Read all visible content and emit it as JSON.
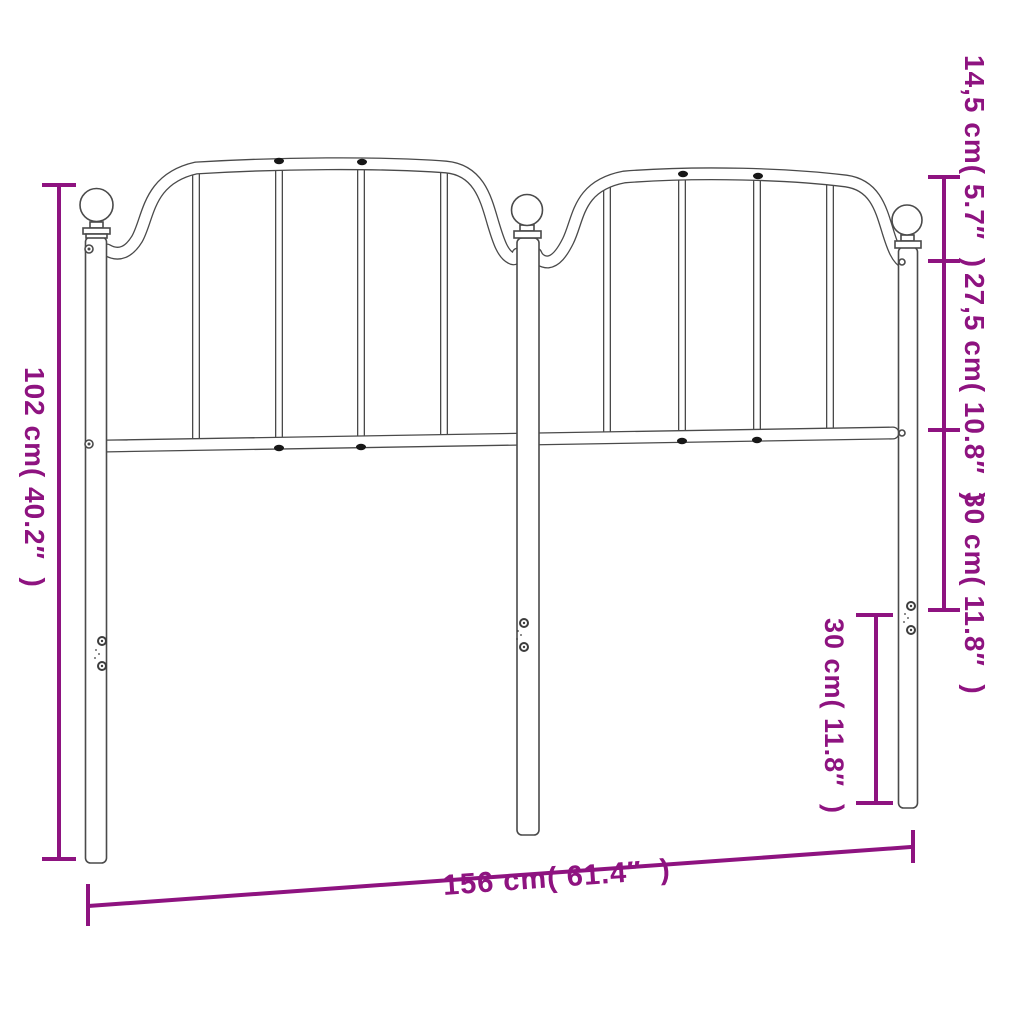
{
  "style": {
    "accent_color": "#8e1380",
    "drawing_line_color": "#4a4a4a",
    "background": "#ffffff"
  },
  "dimensions": {
    "height": {
      "label": "102 cm( 40.2″  )",
      "cm": "102",
      "inch": "40.2"
    },
    "width": {
      "label": "156 cm( 61.4″  )",
      "cm": "156",
      "inch": "61.4"
    },
    "top_rail_drop": {
      "label": "14,5 cm( 5.7″  )",
      "cm": "14,5",
      "inch": "5.7"
    },
    "panel_height": {
      "label": "27,5 cm( 10.8″  )",
      "cm": "27,5",
      "inch": "10.8"
    },
    "rail_to_leg": {
      "label": "30 cm( 11.8″  )",
      "cm": "30",
      "inch": "11.8"
    },
    "leg_section": {
      "label": "30 cm( 11.8″  )",
      "cm": "30",
      "inch": "11.8"
    }
  }
}
